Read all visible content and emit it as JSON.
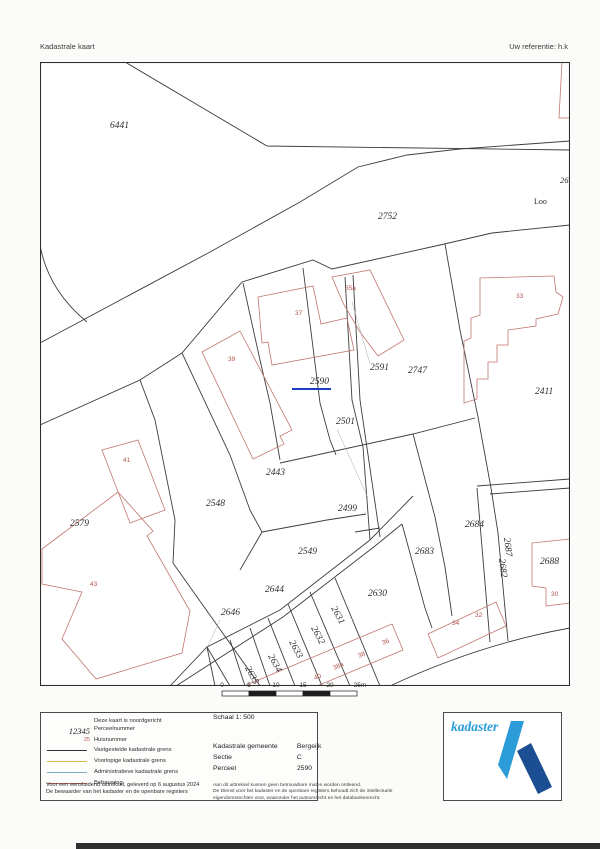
{
  "header": {
    "title": "Kadastrale kaart",
    "reference": "Uw referentie: h.k"
  },
  "map": {
    "subject_parcel": "2590",
    "parcel_labels": [
      {
        "t": "6441",
        "x": 70,
        "y": 66
      },
      {
        "t": "2752",
        "x": 338,
        "y": 157
      },
      {
        "t": "26",
        "x": 520,
        "y": 121
      },
      {
        "t": "2590",
        "x": 270,
        "y": 322,
        "subject": true
      },
      {
        "t": "2591",
        "x": 330,
        "y": 308
      },
      {
        "t": "2747",
        "x": 368,
        "y": 311
      },
      {
        "t": "2501",
        "x": 296,
        "y": 362
      },
      {
        "t": "2411",
        "x": 495,
        "y": 332
      },
      {
        "t": "2443",
        "x": 226,
        "y": 413
      },
      {
        "t": "2548",
        "x": 166,
        "y": 444
      },
      {
        "t": "2579",
        "x": 30,
        "y": 464
      },
      {
        "t": "2499",
        "x": 298,
        "y": 449
      },
      {
        "t": "2549",
        "x": 258,
        "y": 492
      },
      {
        "t": "2644",
        "x": 225,
        "y": 530
      },
      {
        "t": "2646",
        "x": 181,
        "y": 553
      },
      {
        "t": "2630",
        "x": 328,
        "y": 534
      },
      {
        "t": "2683",
        "x": 375,
        "y": 492
      },
      {
        "t": "2684",
        "x": 425,
        "y": 465
      },
      {
        "t": "2688",
        "x": 500,
        "y": 502
      },
      {
        "t": "2631",
        "x": 291,
        "y": 546,
        "r": 62
      },
      {
        "t": "2632",
        "x": 271,
        "y": 566,
        "r": 62
      },
      {
        "t": "2633",
        "x": 249,
        "y": 580,
        "r": 62
      },
      {
        "t": "2634",
        "x": 228,
        "y": 594,
        "r": 62
      },
      {
        "t": "2635",
        "x": 205,
        "y": 606,
        "r": 62
      },
      {
        "t": "2687",
        "x": 464,
        "y": 476,
        "r": 83
      },
      {
        "t": "2682",
        "x": 459,
        "y": 497,
        "r": 83
      }
    ],
    "house_numbers": [
      {
        "t": "41",
        "x": 83,
        "y": 400
      },
      {
        "t": "43",
        "x": 50,
        "y": 524
      },
      {
        "t": "39",
        "x": 188,
        "y": 299
      },
      {
        "t": "37",
        "x": 255,
        "y": 253
      },
      {
        "t": "35a",
        "x": 305,
        "y": 228
      },
      {
        "t": "33",
        "x": 476,
        "y": 236
      },
      {
        "t": "34",
        "x": 412,
        "y": 563
      },
      {
        "t": "32",
        "x": 435,
        "y": 555
      },
      {
        "t": "30",
        "x": 511,
        "y": 534
      },
      {
        "t": "40",
        "x": 275,
        "y": 618,
        "r": -23
      },
      {
        "t": "38a",
        "x": 294,
        "y": 608,
        "r": -23
      },
      {
        "t": "38",
        "x": 319,
        "y": 596,
        "r": -23
      },
      {
        "t": "36",
        "x": 343,
        "y": 583,
        "r": -23
      }
    ],
    "road_labels": [
      {
        "t": "Loo",
        "x": 494,
        "y": 142
      }
    ],
    "colors": {
      "boundary_established": "#3d3d3d",
      "boundary_provisional": "#d9b94a",
      "boundary_administrative": "#7aabcc",
      "building": "#c1766e",
      "subject_marker_blue": "#1d3fbf",
      "house_number_red": "#b0544c"
    }
  },
  "scale_bar": {
    "ticks": [
      "0",
      "5",
      "10",
      "15",
      "20",
      "25m"
    ]
  },
  "legend": {
    "north_note": "Deze kaart is noordgericht",
    "items": [
      {
        "symbol": "12345",
        "label": "Perceelnummer"
      },
      {
        "symbol": "25",
        "label": "Huisnummer"
      },
      {
        "symbol": "line-black",
        "label": "Vastgestelde kadastrale grens"
      },
      {
        "symbol": "line-yellow",
        "label": "Voorlopige kadastrale grens"
      },
      {
        "symbol": "line-blue",
        "label": "Administratieve kadastrale grens"
      },
      {
        "symbol": "line-red",
        "label": "Bebouwing"
      }
    ],
    "footer_line1": "Voor een eensluidend uittreksel, geleverd op 6 augustus 2024",
    "footer_line2": "De bewaarder van het kadaster en de openbare registers"
  },
  "details": {
    "schaal": "Schaal 1: 500",
    "rows": [
      {
        "label": "Kadastrale gemeente",
        "value": "Bergeijk"
      },
      {
        "label": "Sectie",
        "value": "C"
      },
      {
        "label": "Perceel",
        "value": "2590"
      }
    ],
    "disclaimer_line1": "Aan dit uittreksel kunnen geen betrouwbare maten worden ontleend.",
    "disclaimer_line2": "De Dienst voor het kadaster en de openbare registers behoudt zich de intellectuele",
    "disclaimer_line3": "eigendomsrechten voor, waaronder het auteursrecht en het databankenrecht."
  },
  "logo": {
    "text": "kadaster"
  }
}
